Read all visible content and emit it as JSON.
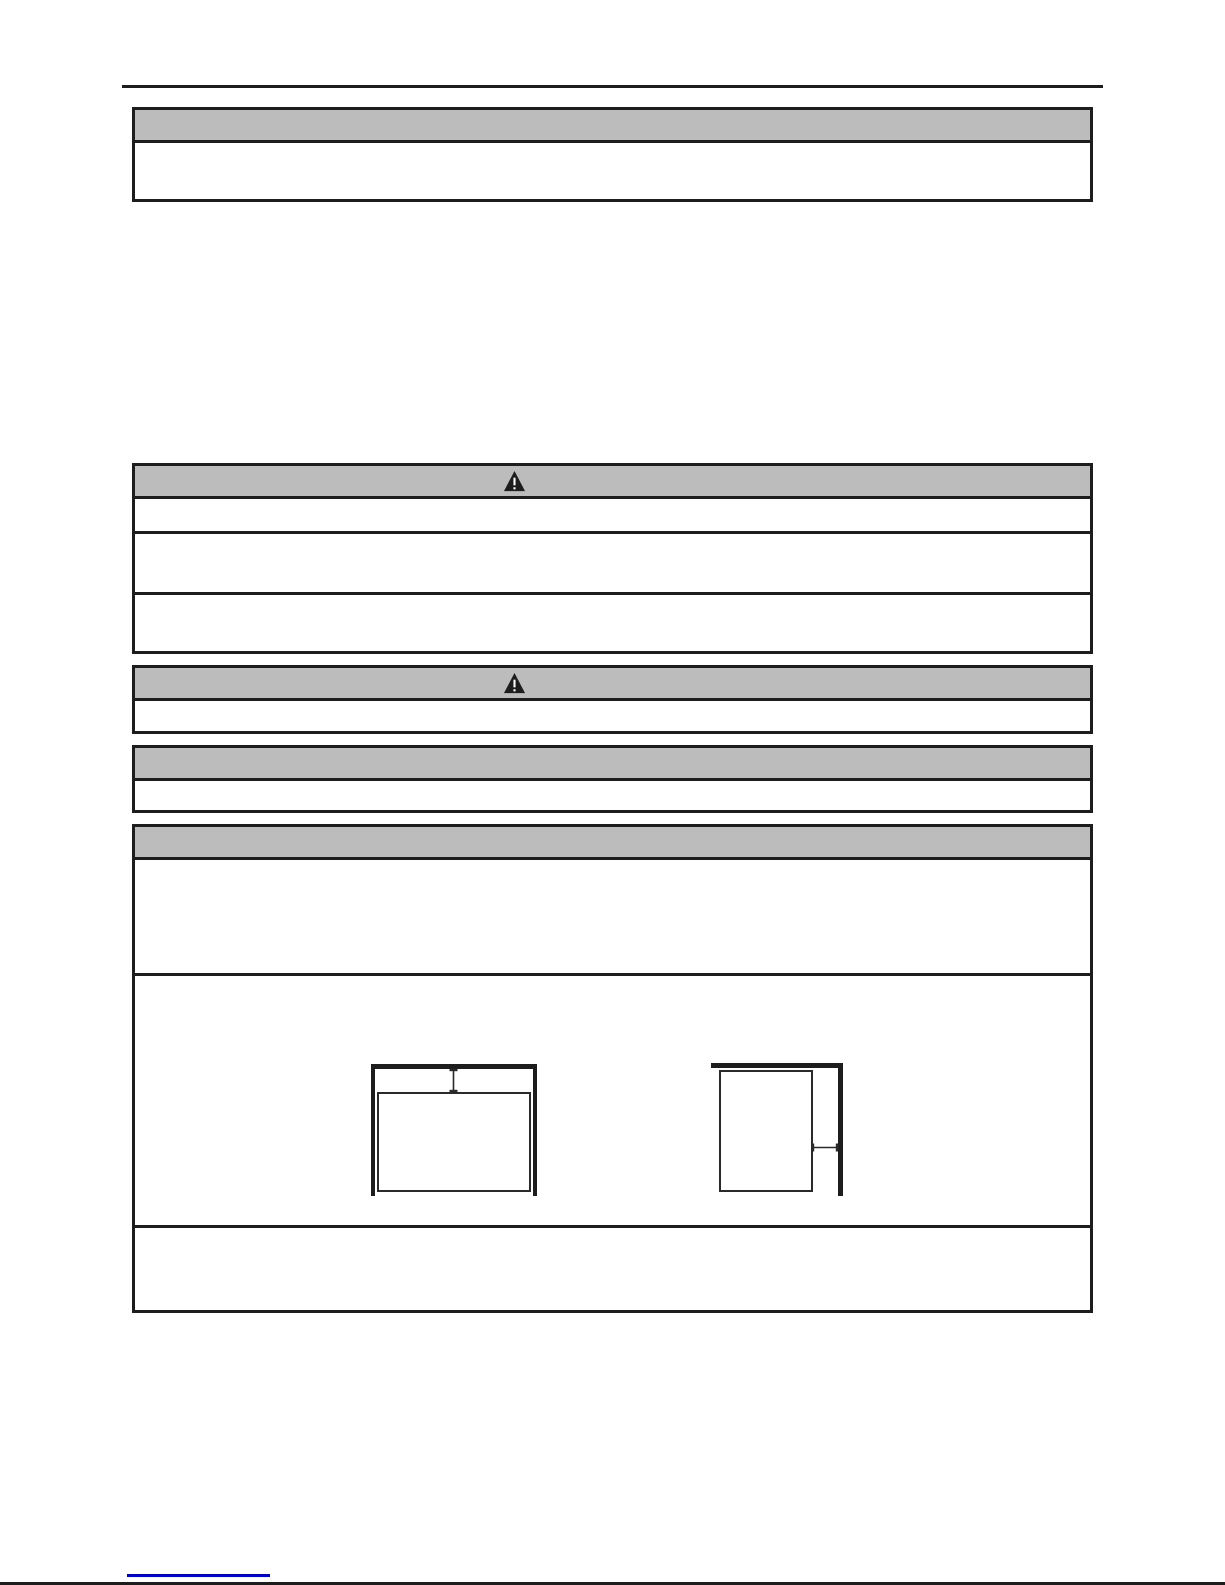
{
  "document": {
    "kind": "manual-page",
    "visible_text": "",
    "note_fields_omitted": ""
  },
  "colors": {
    "page_background": "#ffffff",
    "header_fill": "#bcbcbc",
    "border_ink": "#1d1d1d",
    "link_blue": "#0000cd"
  },
  "rules": {
    "top_rule": {
      "present": true
    },
    "bottom_rule": {
      "present": true
    }
  },
  "sections": [
    {
      "id": "box-1",
      "header_shaded": true,
      "header_icon": "",
      "body_rows": 1
    },
    {
      "id": "box-2",
      "header_shaded": true,
      "header_icon": "warning-triangle",
      "body_rows": 3
    },
    {
      "id": "box-3",
      "header_shaded": true,
      "header_icon": "warning-triangle",
      "body_rows": 1
    },
    {
      "id": "box-4",
      "header_shaded": true,
      "header_icon": "",
      "body_rows": 1
    },
    {
      "id": "box-5",
      "header_shaded": true,
      "header_icon": "",
      "body_rows": 3
    }
  ],
  "icons": {
    "warning_triangle": "filled black triangle with exclamation mark"
  },
  "diagrams": [
    {
      "id": "diagram-left",
      "walls": "ceiling-left-right",
      "dimension_arrow": "vertical-top-gap"
    },
    {
      "id": "diagram-right",
      "walls": "ceiling-right",
      "dimension_arrow": "horizontal-side-gap"
    }
  ],
  "footer": {
    "link": {
      "text": "",
      "underline_only": true
    }
  }
}
